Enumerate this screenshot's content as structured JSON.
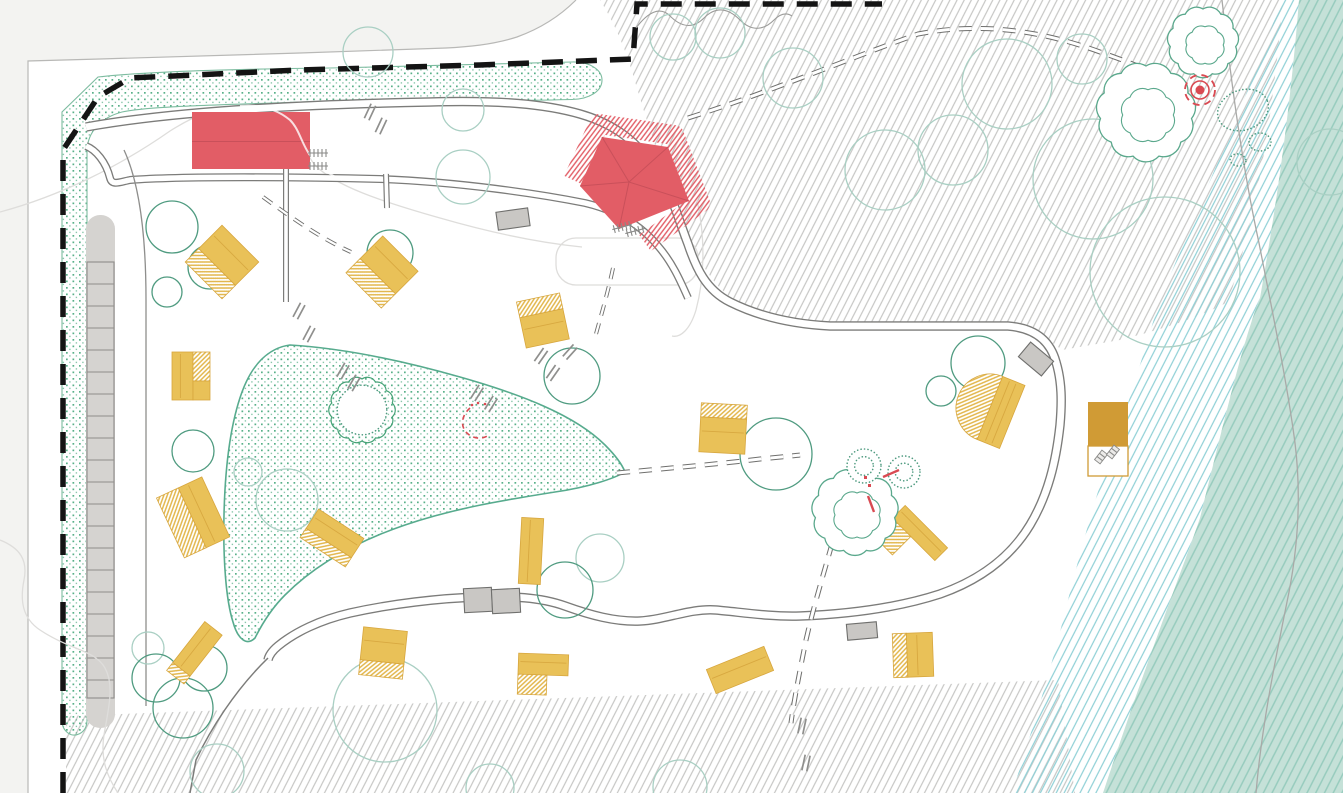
{
  "meta": {
    "width": 1343,
    "height": 793
  },
  "palette": {
    "outside_bg": "#f3f3f1",
    "site_bg": "#ffffff",
    "boundary": "#141414",
    "property_line": "#b8b8b6",
    "road": "#7c7c7a",
    "faint": "#dedddb",
    "contour": "#a9a9a7",
    "gray_hatch": "#c6c6c4",
    "cyan_hatch": "#8fd0d6",
    "teal_fill": "#c5e1d8",
    "teal_hatch": "#96cbbd",
    "stipple_dot": "#3ba273",
    "stipple_edge": "#57ab8e",
    "tree_light": "#a9cfc3",
    "tree_mid": "#7ab7a1",
    "tree_dark": "#4f9b80",
    "cloud_tree": "#5aa88c",
    "red_building": "#e25d66",
    "red_line": "#c9505a",
    "red_marker": "#d94a52",
    "cabin_yellow": "#e9c158",
    "cabin_stripe": "#e2b64b",
    "cabin_line": "#d7a63e",
    "utility_mustard": "#d09b35",
    "parking_fill": "#d5d3d0",
    "parking_line": "#8f8d8a",
    "lot_fill": "#c9c7c4",
    "glyph_gray": "#8a8a88"
  },
  "features": [
    {
      "id": "site-boundary",
      "symbol": "black dashed line"
    },
    {
      "id": "buffer-planting-band",
      "symbol": "green stippled band"
    },
    {
      "id": "pond-meadow",
      "symbol": "green stippled organic shape"
    },
    {
      "id": "loop-road",
      "symbol": "double gray line"
    },
    {
      "id": "footpath",
      "symbol": "double dashed gray line"
    },
    {
      "id": "parking-bays",
      "symbol": "gray strip with stalls"
    },
    {
      "id": "reception-building",
      "symbol": "red rectangle",
      "count": 1
    },
    {
      "id": "pavilion",
      "symbol": "red pentagon with hatched canopy",
      "count": 1
    },
    {
      "id": "cabin",
      "symbol": "yellow rectangle, part hatched",
      "count": 14
    },
    {
      "id": "fan-building",
      "symbol": "yellow fan shape",
      "count": 1
    },
    {
      "id": "utility-building",
      "symbol": "mustard square with bench annex",
      "count": 1
    },
    {
      "id": "tree",
      "symbol": "green circle",
      "count": 34
    },
    {
      "id": "detailed-tree",
      "symbol": "sketched cloud canopy",
      "count": 3
    },
    {
      "id": "shrub",
      "symbol": "dotted circle",
      "count": 2
    },
    {
      "id": "campfire-spot",
      "symbol": "red target with dashed ring",
      "count": 1
    },
    {
      "id": "woodland-hatch",
      "symbol": "gray diagonal hatch"
    },
    {
      "id": "shore-hatch",
      "symbol": "cyan diagonal hatch"
    },
    {
      "id": "water-band",
      "symbol": "teal hatched band"
    },
    {
      "id": "car-space",
      "symbol": "gray rectangle",
      "count": 5
    },
    {
      "id": "bike-rack",
      "symbol": "gray tick row",
      "count": 4
    },
    {
      "id": "bench",
      "symbol": "small gray rectangle",
      "count": 2
    }
  ],
  "parking_strip": {
    "x": 86,
    "y": 215,
    "w": 29,
    "h": 513,
    "stall_top": 262,
    "stall_bottom": 698,
    "step": 22
  },
  "red_admin": {
    "x": 192,
    "y": 112,
    "w": 118,
    "h": 57
  },
  "pavilion": {
    "pts": [
      [
        602,
        137
      ],
      [
        668,
        147
      ],
      [
        689,
        201
      ],
      [
        619,
        229
      ],
      [
        580,
        186
      ]
    ],
    "center": [
      629,
      182
    ],
    "halo": [
      [
        573,
        180
      ],
      [
        599,
        124
      ],
      [
        674,
        135
      ],
      [
        700,
        203
      ],
      [
        645,
        243
      ]
    ]
  },
  "fan": {
    "cx": 990,
    "cy": 408,
    "rot": 22,
    "r": 34,
    "rw": 24
  },
  "utility": {
    "x": 1088,
    "y": 402,
    "w": 40,
    "h": 44,
    "annex_h": 30
  },
  "campfire": {
    "x": 1200,
    "y": 90
  },
  "cabins": [
    {
      "cx": 222,
      "cy": 262,
      "rot": 45,
      "parts": [
        [
          -26,
          -26,
          52,
          33,
          "s"
        ],
        [
          -26,
          7,
          52,
          19,
          "h"
        ]
      ]
    },
    {
      "cx": 382,
      "cy": 272,
      "rot": 45,
      "parts": [
        [
          -25,
          -26,
          50,
          32,
          "s"
        ],
        [
          -25,
          6,
          50,
          20,
          "h"
        ]
      ]
    },
    {
      "cx": 543,
      "cy": 321,
      "rot": -12,
      "parts": [
        [
          -22,
          -8,
          44,
          31,
          "s"
        ],
        [
          -22,
          -24,
          44,
          16,
          "h"
        ]
      ]
    },
    {
      "cx": 191,
      "cy": 376,
      "rot": 0,
      "parts": [
        [
          -19,
          -24,
          21,
          48,
          "s"
        ],
        [
          2,
          -24,
          17,
          29,
          "h"
        ],
        [
          2,
          5,
          17,
          19,
          "s"
        ]
      ]
    },
    {
      "cx": 194,
      "cy": 517,
      "rot": -25,
      "parts": [
        [
          -2,
          -33,
          26,
          66,
          "s"
        ],
        [
          -26,
          -33,
          24,
          66,
          "h"
        ]
      ]
    },
    {
      "cx": 195,
      "cy": 652,
      "rot": 38,
      "parts": [
        [
          -11,
          -30,
          22,
          52,
          "s"
        ],
        [
          -11,
          22,
          22,
          10,
          "h"
        ]
      ]
    },
    {
      "cx": 332,
      "cy": 538,
      "rot": 33,
      "parts": [
        [
          -27,
          -17,
          54,
          23,
          "s"
        ],
        [
          -27,
          6,
          54,
          11,
          "h"
        ]
      ]
    },
    {
      "cx": 383,
      "cy": 653,
      "rot": 6,
      "parts": [
        [
          -22,
          -24,
          44,
          33,
          "s"
        ],
        [
          -22,
          9,
          44,
          15,
          "h"
        ]
      ]
    },
    {
      "cx": 531,
      "cy": 551,
      "rot": 3,
      "parts": [
        [
          -11,
          -33,
          22,
          66,
          "s"
        ]
      ]
    },
    {
      "cx": 723,
      "cy": 430,
      "rot": 3,
      "parts": [
        [
          -23,
          -12,
          46,
          35,
          "s"
        ],
        [
          -23,
          -26,
          46,
          14,
          "h"
        ]
      ]
    },
    {
      "cx": 543,
      "cy": 674,
      "rot": 2,
      "parts": [
        [
          -25,
          -20,
          50,
          21,
          "s"
        ],
        [
          -25,
          1,
          29,
          20,
          "h"
        ]
      ]
    },
    {
      "cx": 920,
      "cy": 533,
      "rot": 45,
      "parts": [
        [
          -30,
          -9,
          60,
          18,
          "s"
        ],
        [
          -30,
          9,
          26,
          26,
          "h"
        ]
      ]
    },
    {
      "cx": 913,
      "cy": 655,
      "rot": -2,
      "parts": [
        [
          -6,
          -22,
          26,
          44,
          "s"
        ],
        [
          -20,
          -22,
          14,
          44,
          "h"
        ]
      ]
    },
    {
      "cx": 740,
      "cy": 670,
      "rot": -22,
      "parts": [
        [
          -31,
          -13,
          62,
          26,
          "s"
        ]
      ]
    }
  ],
  "trees": [
    [
      368,
      52,
      25,
      "l"
    ],
    [
      463,
      110,
      21,
      "l"
    ],
    [
      463,
      177,
      27,
      "l"
    ],
    [
      720,
      33,
      25,
      "l"
    ],
    [
      673,
      37,
      23,
      "l"
    ],
    [
      793,
      78,
      30,
      "l"
    ],
    [
      1007,
      84,
      45,
      "l"
    ],
    [
      1082,
      59,
      25,
      "l"
    ],
    [
      953,
      150,
      35,
      "l"
    ],
    [
      885,
      170,
      40,
      "l"
    ],
    [
      1093,
      179,
      60,
      "l"
    ],
    [
      1330,
      162,
      33,
      "l"
    ],
    [
      1165,
      272,
      75,
      "l"
    ],
    [
      172,
      227,
      26,
      "d"
    ],
    [
      210,
      267,
      22,
      "d"
    ],
    [
      167,
      292,
      15,
      "d"
    ],
    [
      390,
      253,
      23,
      "d"
    ],
    [
      572,
      376,
      28,
      "d"
    ],
    [
      193,
      451,
      21,
      "d"
    ],
    [
      248,
      472,
      14,
      "l"
    ],
    [
      287,
      500,
      31,
      "l"
    ],
    [
      776,
      454,
      36,
      "d"
    ],
    [
      978,
      363,
      27,
      "d"
    ],
    [
      941,
      391,
      15,
      "d"
    ],
    [
      600,
      558,
      24,
      "l"
    ],
    [
      565,
      590,
      28,
      "d"
    ],
    [
      148,
      648,
      16,
      "l"
    ],
    [
      156,
      678,
      24,
      "d"
    ],
    [
      204,
      668,
      23,
      "d"
    ],
    [
      183,
      708,
      30,
      "d"
    ],
    [
      217,
      771,
      27,
      "l"
    ],
    [
      385,
      710,
      52,
      "l"
    ],
    [
      490,
      788,
      24,
      "l"
    ],
    [
      680,
      787,
      27,
      "l"
    ]
  ],
  "cloud_trees": [
    [
      1203,
      42,
      33
    ],
    [
      1146,
      112,
      46
    ],
    [
      855,
      512,
      40
    ]
  ],
  "shrubs": [
    [
      864,
      466,
      17
    ],
    [
      904,
      472,
      16
    ]
  ],
  "scribble_tree": {
    "x": 362,
    "y": 410,
    "r": 31
  },
  "stipple_patches": [
    [
      1243,
      110,
      26,
      20,
      -20
    ],
    [
      1260,
      142,
      11,
      9,
      0
    ],
    [
      1238,
      160,
      8,
      6,
      10
    ]
  ],
  "lots": [
    [
      513,
      219,
      32,
      18,
      -8
    ],
    [
      1036,
      359,
      30,
      19,
      40
    ],
    [
      478,
      600,
      28,
      24,
      -3
    ],
    [
      506,
      601,
      28,
      24,
      -3
    ],
    [
      862,
      631,
      30,
      16,
      -5
    ]
  ],
  "ticks": [
    [
      299,
      311,
      62
    ],
    [
      309,
      334,
      62
    ],
    [
      343,
      371,
      60
    ],
    [
      354,
      383,
      60
    ],
    [
      477,
      393,
      58
    ],
    [
      491,
      404,
      58
    ],
    [
      541,
      356,
      55
    ],
    [
      553,
      373,
      55
    ],
    [
      570,
      352,
      48
    ],
    [
      802,
      726,
      78
    ],
    [
      806,
      763,
      78
    ],
    [
      370,
      112,
      65
    ],
    [
      381,
      126,
      65
    ]
  ],
  "racks": [
    [
      318,
      153,
      0
    ],
    [
      318,
      166,
      0
    ],
    [
      622,
      227,
      -15
    ],
    [
      635,
      231,
      -15
    ]
  ],
  "benches": [
    [
      1101,
      457,
      38
    ],
    [
      1113,
      452,
      38
    ]
  ],
  "red_details": {
    "lines": [
      [
        883,
        477,
        899,
        470
      ],
      [
        868,
        496,
        874,
        512
      ]
    ],
    "squares": [
      [
        864,
        476
      ],
      [
        868,
        484
      ]
    ],
    "arc": {
      "d": "M470,408 C462,415 460,425 466,432 C472,439 482,440 489,435",
      "dots": [
        [
          472,
          405
        ],
        [
          478,
          403
        ],
        [
          485,
          404
        ]
      ]
    }
  }
}
